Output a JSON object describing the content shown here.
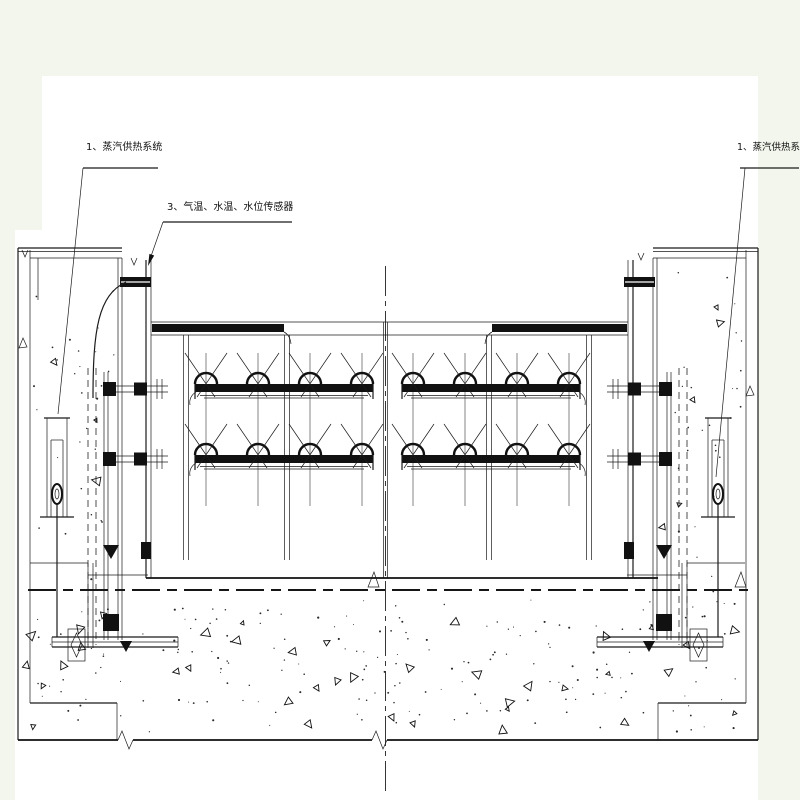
{
  "drawing": {
    "labels": {
      "steam_left": "1、蒸汽供热系统",
      "sensors": "3、气温、水温、水位传感器",
      "steam_right": "1、蒸汽供热系统"
    },
    "colors": {
      "line": "#1b1b1b",
      "paper": "#ffffff",
      "margin": "#f3f6ec"
    }
  }
}
